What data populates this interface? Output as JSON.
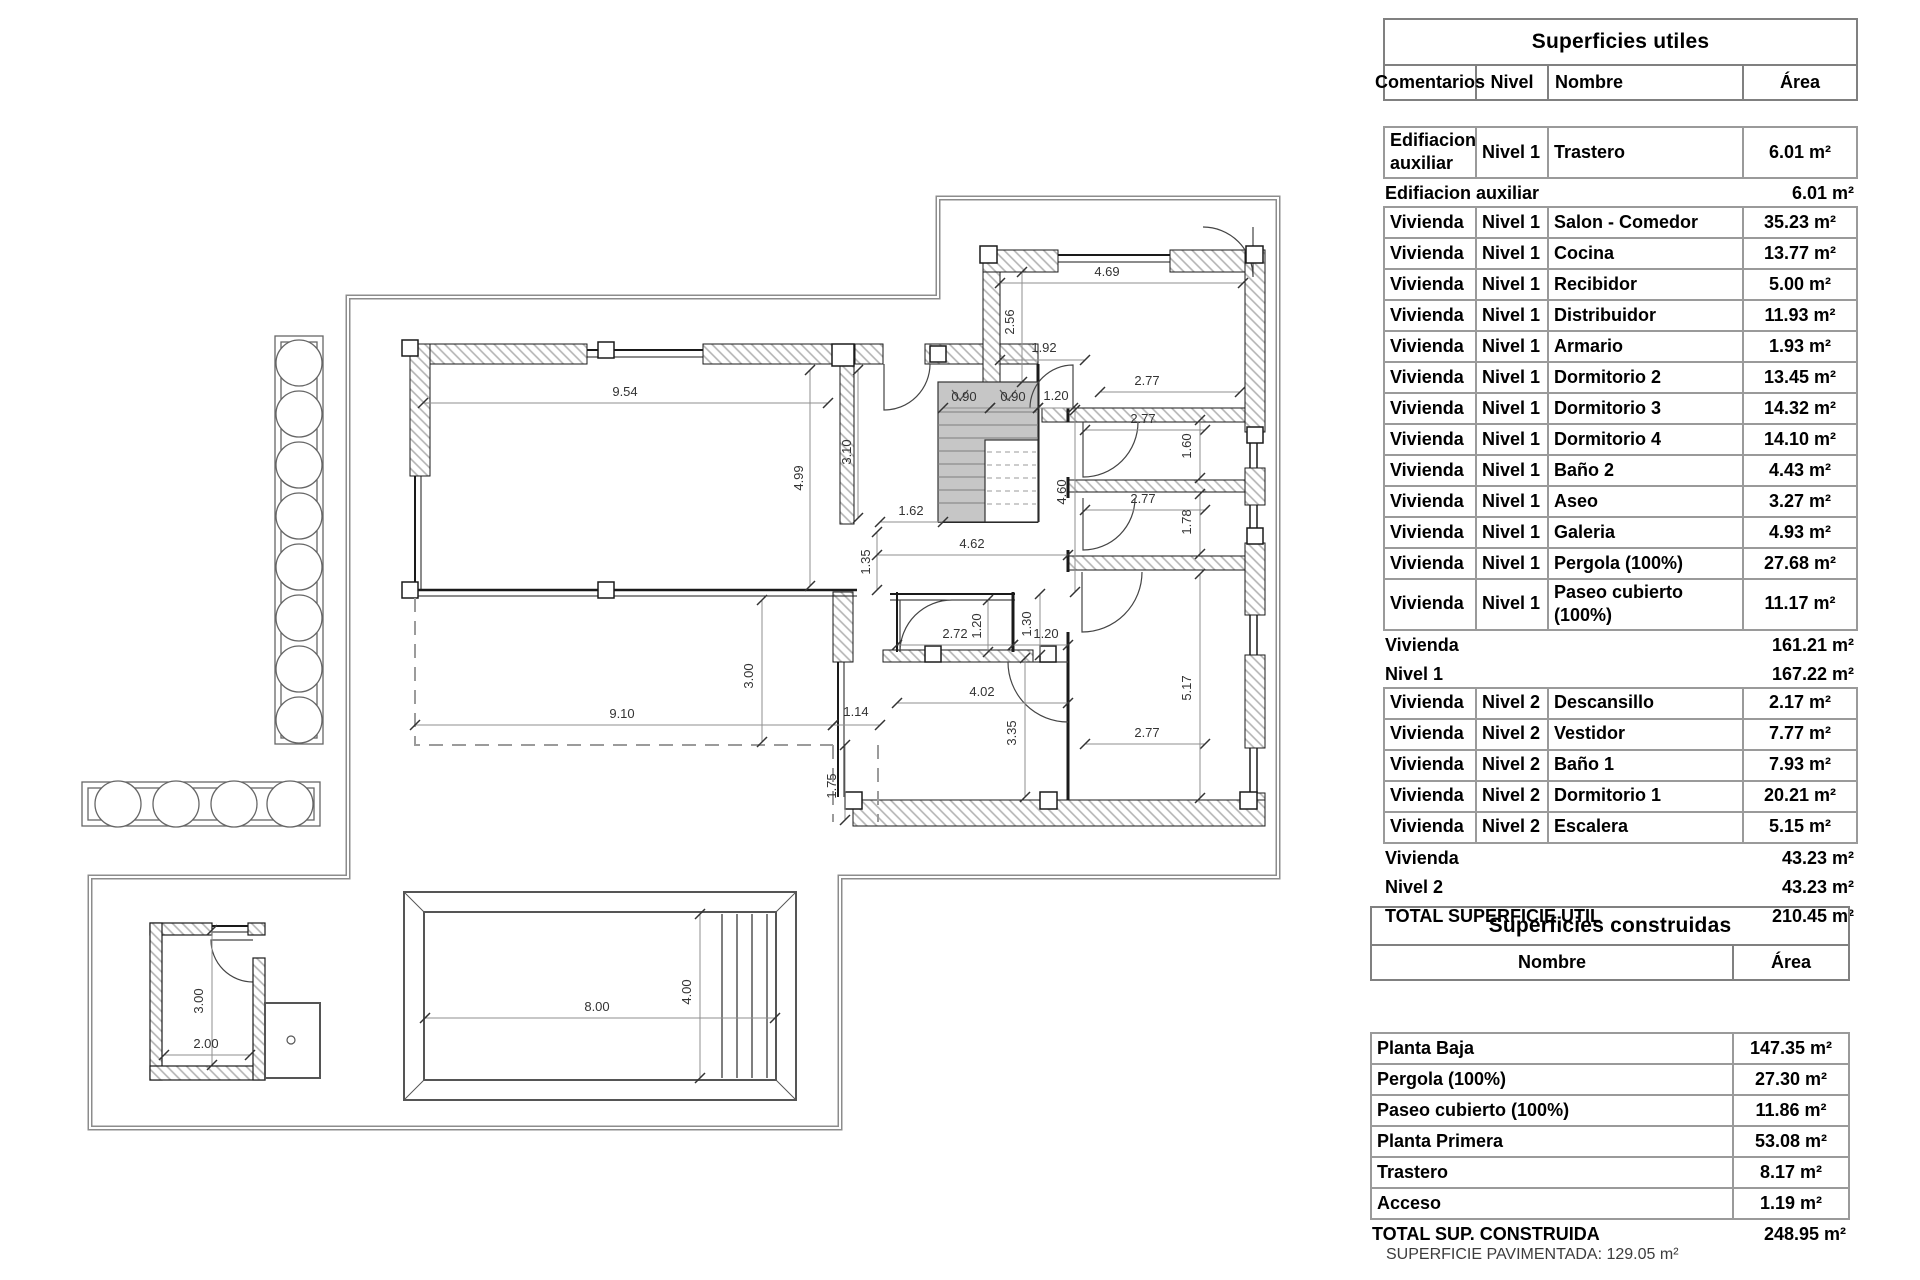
{
  "tables": {
    "utiles": {
      "title": "Superficies utiles",
      "columns": [
        "Comentarios",
        "Nivel",
        "Nombre",
        "Área"
      ],
      "rows": [
        {
          "c": [
            "Edifiacion auxiliar",
            "Nivel 1",
            "Trastero",
            "6.01 m²"
          ]
        },
        {
          "label": "Edifiacion auxiliar",
          "value": "6.01 m²"
        },
        {
          "c": [
            "Vivienda",
            "Nivel 1",
            "Salon - Comedor",
            "35.23 m²"
          ]
        },
        {
          "c": [
            "Vivienda",
            "Nivel 1",
            "Cocina",
            "13.77 m²"
          ]
        },
        {
          "c": [
            "Vivienda",
            "Nivel 1",
            "Recibidor",
            "5.00 m²"
          ]
        },
        {
          "c": [
            "Vivienda",
            "Nivel 1",
            "Distribuidor",
            "11.93 m²"
          ]
        },
        {
          "c": [
            "Vivienda",
            "Nivel 1",
            "Armario",
            "1.93 m²"
          ]
        },
        {
          "c": [
            "Vivienda",
            "Nivel 1",
            "Dormitorio 2",
            "13.45 m²"
          ]
        },
        {
          "c": [
            "Vivienda",
            "Nivel 1",
            "Dormitorio 3",
            "14.32 m²"
          ]
        },
        {
          "c": [
            "Vivienda",
            "Nivel 1",
            "Dormitorio 4",
            "14.10 m²"
          ]
        },
        {
          "c": [
            "Vivienda",
            "Nivel 1",
            "Baño 2",
            "4.43 m²"
          ]
        },
        {
          "c": [
            "Vivienda",
            "Nivel 1",
            "Aseo",
            "3.27 m²"
          ]
        },
        {
          "c": [
            "Vivienda",
            "Nivel 1",
            "Galeria",
            "4.93 m²"
          ]
        },
        {
          "c": [
            "Vivienda",
            "Nivel 1",
            "Pergola (100%)",
            "27.68 m²"
          ]
        },
        {
          "c": [
            "Vivienda",
            "Nivel 1",
            "Paseo cubierto (100%)",
            "11.17 m²"
          ]
        },
        {
          "label": "Vivienda",
          "value": "161.21 m²"
        },
        {
          "label": "Nivel 1",
          "value": "167.22 m²"
        },
        {
          "c": [
            "Vivienda",
            "Nivel 2",
            "Descansillo",
            "2.17 m²"
          ]
        },
        {
          "c": [
            "Vivienda",
            "Nivel 2",
            "Vestidor",
            "7.77 m²"
          ]
        },
        {
          "c": [
            "Vivienda",
            "Nivel 2",
            "Baño 1",
            "7.93 m²"
          ]
        },
        {
          "c": [
            "Vivienda",
            "Nivel 2",
            "Dormitorio 1",
            "20.21 m²"
          ]
        },
        {
          "c": [
            "Vivienda",
            "Nivel 2",
            "Escalera",
            "5.15 m²"
          ]
        },
        {
          "label": "Vivienda",
          "value": "43.23 m²"
        },
        {
          "label": "Nivel 2",
          "value": "43.23 m²"
        },
        {
          "label": "TOTAL SUPERFICIE UTIL",
          "value": "210.45 m²"
        }
      ]
    },
    "construidas": {
      "title": "Superficies construidas",
      "columns": [
        "Nombre",
        "Área"
      ],
      "rows": [
        {
          "c": [
            "Planta Baja",
            "147.35 m²"
          ]
        },
        {
          "c": [
            "Pergola (100%)",
            "27.30 m²"
          ]
        },
        {
          "c": [
            "Paseo cubierto (100%)",
            "11.86 m²"
          ]
        },
        {
          "c": [
            "Planta Primera",
            "53.08 m²"
          ]
        },
        {
          "c": [
            "Trastero",
            "8.17 m²"
          ]
        },
        {
          "c": [
            "Acceso",
            "1.19 m²"
          ]
        },
        {
          "label": "TOTAL SUP. CONSTRUIDA",
          "value": "248.95 m²"
        }
      ]
    }
  },
  "footer": {
    "note": "SUPERFICIE PAVIMENTADA: 129.05 m²"
  },
  "plan": {
    "colors": {
      "wall_hatch": "#b3b3b3",
      "stair_fill": "#c6c6c6",
      "boundary": "#8c8c8c"
    },
    "dims": [
      {
        "t": "9.54",
        "x1": 423,
        "y1": 403,
        "x2": 828,
        "y2": 403,
        "lx": 625,
        "ly": 396
      },
      {
        "t": "4.99",
        "x1": 810,
        "y1": 370,
        "x2": 810,
        "y2": 586,
        "lx": 803,
        "ly": 478,
        "rot": 1
      },
      {
        "t": "3.10",
        "x1": 858,
        "y1": 370,
        "x2": 858,
        "y2": 518,
        "lx": 851,
        "ly": 452,
        "rot": 1
      },
      {
        "t": "1.62",
        "x1": 880,
        "y1": 522,
        "x2": 943,
        "y2": 522,
        "lx": 911,
        "ly": 515
      },
      {
        "t": "1.35",
        "x1": 877,
        "y1": 532,
        "x2": 877,
        "y2": 590,
        "lx": 870,
        "ly": 562,
        "rot": 1
      },
      {
        "t": "4.62",
        "x1": 877,
        "y1": 555,
        "x2": 1068,
        "y2": 555,
        "lx": 972,
        "ly": 548
      },
      {
        "t": "4.60",
        "x1": 1075,
        "y1": 410,
        "x2": 1075,
        "y2": 592,
        "lx": 1066,
        "ly": 492,
        "rot": 1
      },
      {
        "t": "4.69",
        "x1": 1000,
        "y1": 283,
        "x2": 1243,
        "y2": 283,
        "lx": 1107,
        "ly": 276
      },
      {
        "t": "2.56",
        "x1": 1022,
        "y1": 272,
        "x2": 1022,
        "y2": 382,
        "lx": 1014,
        "ly": 322,
        "rot": 1
      },
      {
        "t": "1.92",
        "x1": 1000,
        "y1": 360,
        "x2": 1085,
        "y2": 360,
        "lx": 1044,
        "ly": 352
      },
      {
        "t": "2.77",
        "x1": 1100,
        "y1": 392,
        "x2": 1240,
        "y2": 392,
        "lx": 1147,
        "ly": 385
      },
      {
        "t": "2.77",
        "x1": 1085,
        "y1": 430,
        "x2": 1205,
        "y2": 430,
        "lx": 1143,
        "ly": 423
      },
      {
        "t": "1.60",
        "x1": 1200,
        "y1": 420,
        "x2": 1200,
        "y2": 478,
        "lx": 1191,
        "ly": 446,
        "rot": 1
      },
      {
        "t": "2.77",
        "x1": 1085,
        "y1": 510,
        "x2": 1205,
        "y2": 510,
        "lx": 1143,
        "ly": 503
      },
      {
        "t": "1.78",
        "x1": 1200,
        "y1": 494,
        "x2": 1200,
        "y2": 554,
        "lx": 1191,
        "ly": 522,
        "rot": 1
      },
      {
        "t": "2.77",
        "x1": 1085,
        "y1": 744,
        "x2": 1205,
        "y2": 744,
        "lx": 1147,
        "ly": 737
      },
      {
        "t": "5.17",
        "x1": 1200,
        "y1": 574,
        "x2": 1200,
        "y2": 798,
        "lx": 1191,
        "ly": 688,
        "rot": 1
      },
      {
        "t": "0.90",
        "x1": 943,
        "y1": 408,
        "x2": 990,
        "y2": 408,
        "lx": 964,
        "ly": 401
      },
      {
        "t": "0.90",
        "x1": 990,
        "y1": 408,
        "x2": 1038,
        "y2": 408,
        "lx": 1013,
        "ly": 401
      },
      {
        "t": "1.20",
        "x1": 1038,
        "y1": 408,
        "x2": 1073,
        "y2": 408,
        "lx": 1056,
        "ly": 400
      },
      {
        "t": "2.72",
        "x1": 897,
        "y1": 645,
        "x2": 1013,
        "y2": 645,
        "lx": 955,
        "ly": 638
      },
      {
        "t": "1.20",
        "x1": 988,
        "y1": 600,
        "x2": 988,
        "y2": 652,
        "lx": 981,
        "ly": 626,
        "rot": 1
      },
      {
        "t": "1.30",
        "x1": 1040,
        "y1": 594,
        "x2": 1040,
        "y2": 655,
        "lx": 1031,
        "ly": 624,
        "rot": 1
      },
      {
        "t": "1.20",
        "x1": 1013,
        "y1": 645,
        "x2": 1068,
        "y2": 645,
        "lx": 1046,
        "ly": 638
      },
      {
        "t": "4.02",
        "x1": 897,
        "y1": 703,
        "x2": 1068,
        "y2": 703,
        "lx": 982,
        "ly": 696
      },
      {
        "t": "3.35",
        "x1": 1025,
        "y1": 658,
        "x2": 1025,
        "y2": 797,
        "lx": 1016,
        "ly": 733,
        "rot": 1
      },
      {
        "t": "9.10",
        "x1": 415,
        "y1": 725,
        "x2": 833,
        "y2": 725,
        "lx": 622,
        "ly": 718
      },
      {
        "t": "3.00",
        "x1": 762,
        "y1": 600,
        "x2": 762,
        "y2": 742,
        "lx": 753,
        "ly": 676,
        "rot": 1
      },
      {
        "t": "1.14",
        "x1": 833,
        "y1": 725,
        "x2": 880,
        "y2": 725,
        "lx": 856,
        "ly": 716
      },
      {
        "t": "1.75",
        "x1": 845,
        "y1": 745,
        "x2": 845,
        "y2": 820,
        "lx": 836,
        "ly": 786,
        "rot": 1
      },
      {
        "t": "8.00",
        "x1": 425,
        "y1": 1018,
        "x2": 775,
        "y2": 1018,
        "lx": 597,
        "ly": 1011
      },
      {
        "t": "4.00",
        "x1": 700,
        "y1": 914,
        "x2": 700,
        "y2": 1078,
        "lx": 691,
        "ly": 992,
        "rot": 1
      },
      {
        "t": "3.00",
        "x1": 212,
        "y1": 930,
        "x2": 212,
        "y2": 1065,
        "lx": 203,
        "ly": 1001,
        "rot": 1
      },
      {
        "t": "2.00",
        "x1": 164,
        "y1": 1055,
        "x2": 250,
        "y2": 1055,
        "lx": 206,
        "ly": 1048
      }
    ]
  }
}
